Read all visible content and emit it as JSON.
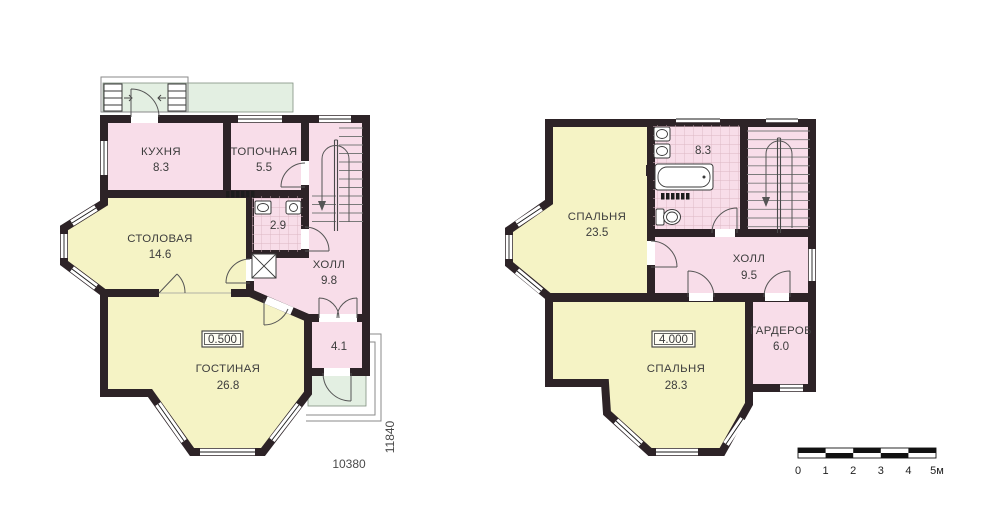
{
  "colors": {
    "wall": "#2d2327",
    "room_pink": "#f8dde9",
    "room_yellow": "#f5f3c5",
    "terrace_green": "#e3efe2",
    "tile_line": "#dcb6c4",
    "text": "#3d3d3d"
  },
  "floor1": {
    "kitchen": {
      "name": "КУХНЯ",
      "area": "8.3"
    },
    "boiler": {
      "name": "ТОПОЧНАЯ",
      "area": "5.5"
    },
    "dining": {
      "name": "СТОЛОВАЯ",
      "area": "14.6"
    },
    "wc": {
      "area": "2.9"
    },
    "hall": {
      "name": "ХОЛЛ",
      "area": "9.8"
    },
    "living": {
      "name": "ГОСТИНАЯ",
      "area": "26.8"
    },
    "tambour": {
      "area": "4.1"
    },
    "elevation": "0.500",
    "dim_width": "10380",
    "dim_height": "11840"
  },
  "floor2": {
    "bedroom1": {
      "name": "СПАЛЬНЯ",
      "area": "23.5"
    },
    "bathroom": {
      "area": "8.3"
    },
    "hall": {
      "name": "ХОЛЛ",
      "area": "9.5"
    },
    "bedroom2": {
      "name": "СПАЛЬНЯ",
      "area": "28.3"
    },
    "wardrobe": {
      "name": "ГАРДЕРОБ",
      "area": "6.0"
    },
    "elevation": "4.000"
  },
  "scale_bar": {
    "labels": [
      "0",
      "1",
      "2",
      "3",
      "4",
      "5м"
    ]
  }
}
